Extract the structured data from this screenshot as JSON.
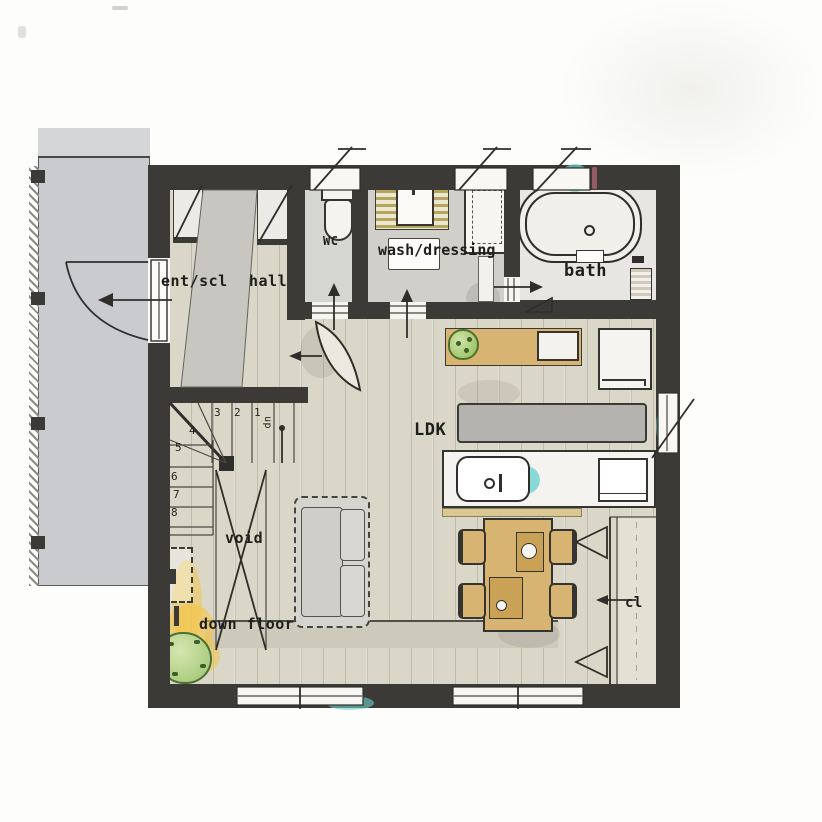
{
  "plan": {
    "type": "floor-plan",
    "rooms": [
      {
        "label": "ent/scl"
      },
      {
        "label": "hall"
      },
      {
        "label": "WC"
      },
      {
        "label": "wash/dressing"
      },
      {
        "label": "bath"
      },
      {
        "label": "LDK"
      },
      {
        "label": "void"
      },
      {
        "label": "down floor"
      },
      {
        "label": "cl"
      }
    ],
    "stairs": {
      "up_label": "up",
      "steps": [
        "1",
        "2",
        "3",
        "4",
        "5",
        "6",
        "7",
        "8"
      ]
    },
    "fixtures": [
      "entry-door",
      "shoe-closet",
      "toilet",
      "washing-machine",
      "vanity-basin",
      "bath-mat",
      "bathtub",
      "shower-counter",
      "kitchen-island-sink",
      "cooktop-counter",
      "refrigerator",
      "sideboard-counter",
      "study-desk",
      "desk-seat",
      "potted-plant",
      "dining-table",
      "dining-chairs",
      "place-settings",
      "sofa",
      "under-stair-storage",
      "garden-tree",
      "closet-folding-doors",
      "high-windows",
      "sliding-windows"
    ],
    "colors": {
      "wall": "#3b3a37",
      "wood_floor": "#dbd7c8",
      "gray_floor": "#d0cfca",
      "porch": "#c9cbce",
      "furniture_tan": "#d8b472",
      "counter_gray": "#b4b3af",
      "accent_cyan": "#6fd2cf",
      "accent_yellow": "#f6c640",
      "tree_green": "#9cc46f",
      "fixture_white": "#f4f3ef"
    }
  }
}
